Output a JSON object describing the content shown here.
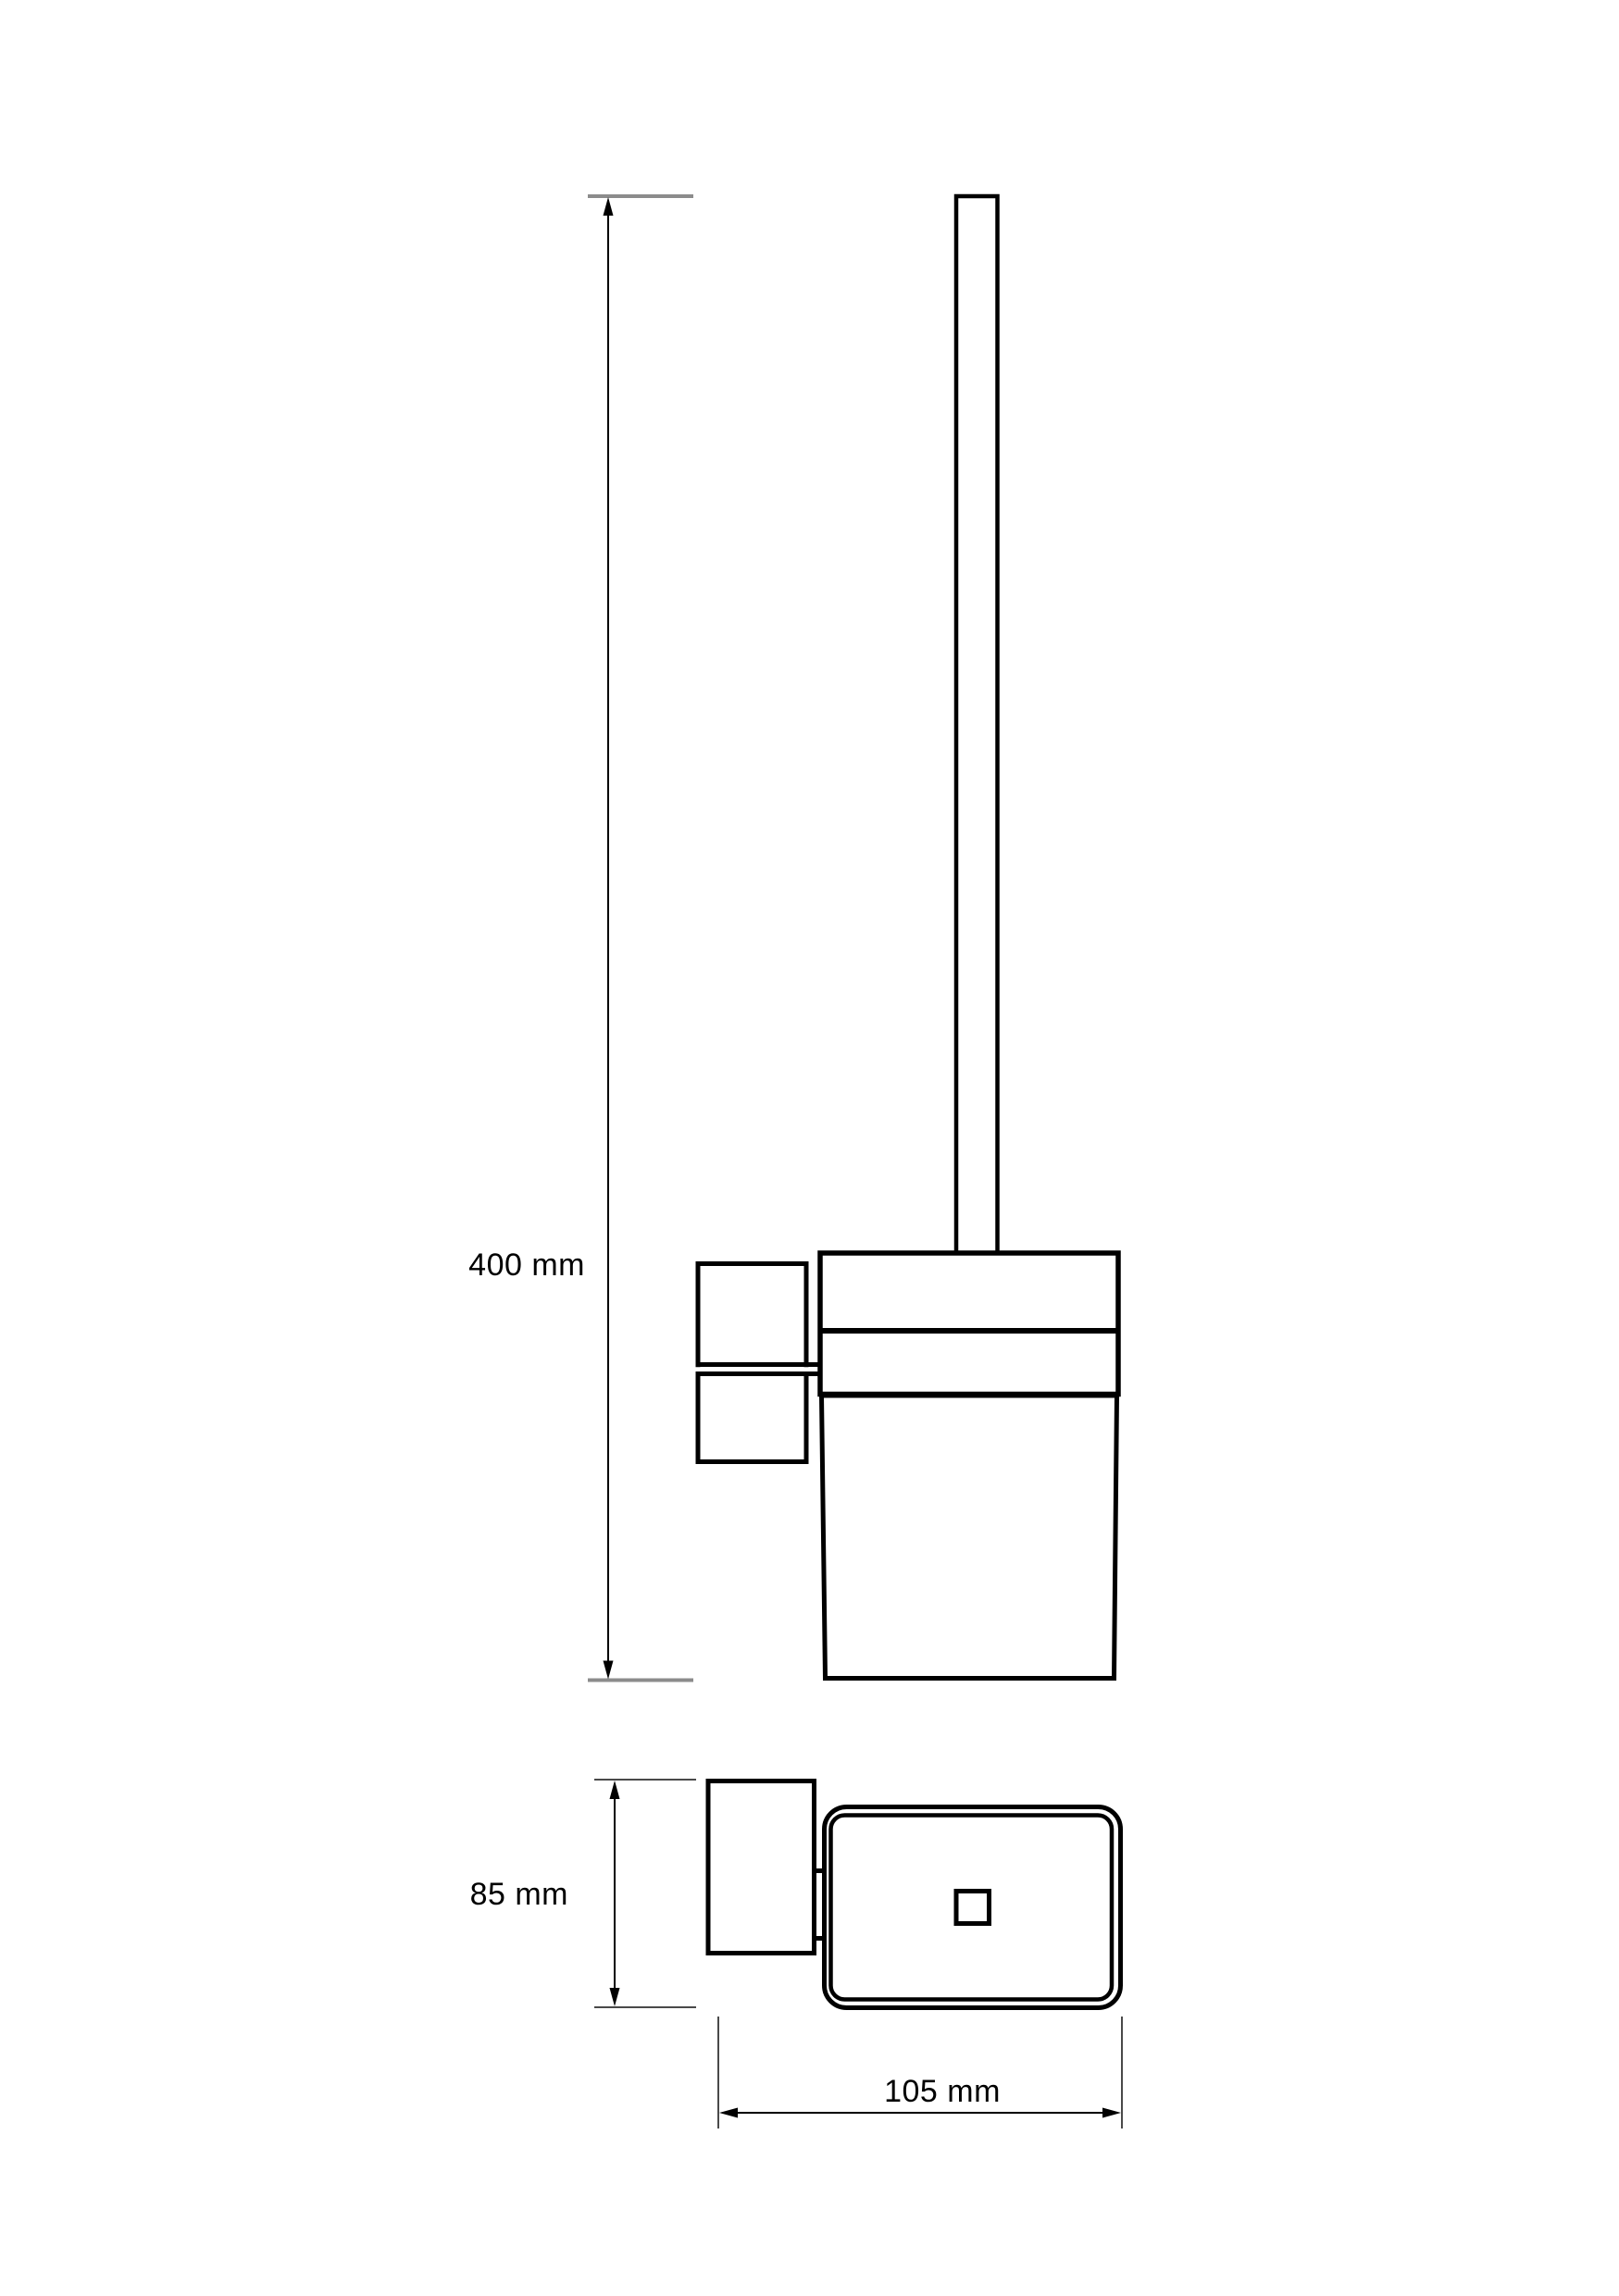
{
  "document": {
    "kind": "technical dimension drawing",
    "views": [
      "front elevation",
      "top plan"
    ]
  },
  "dimensions": {
    "front_height": {
      "label": "400 mm"
    },
    "depth": {
      "label": "85 mm"
    },
    "width": {
      "label": "105 mm"
    }
  },
  "colors": {
    "line": "#000000",
    "extension_line_primary": "#8c8c8c",
    "extension_line_secondary": "#4a4a4a",
    "background": "#ffffff"
  }
}
